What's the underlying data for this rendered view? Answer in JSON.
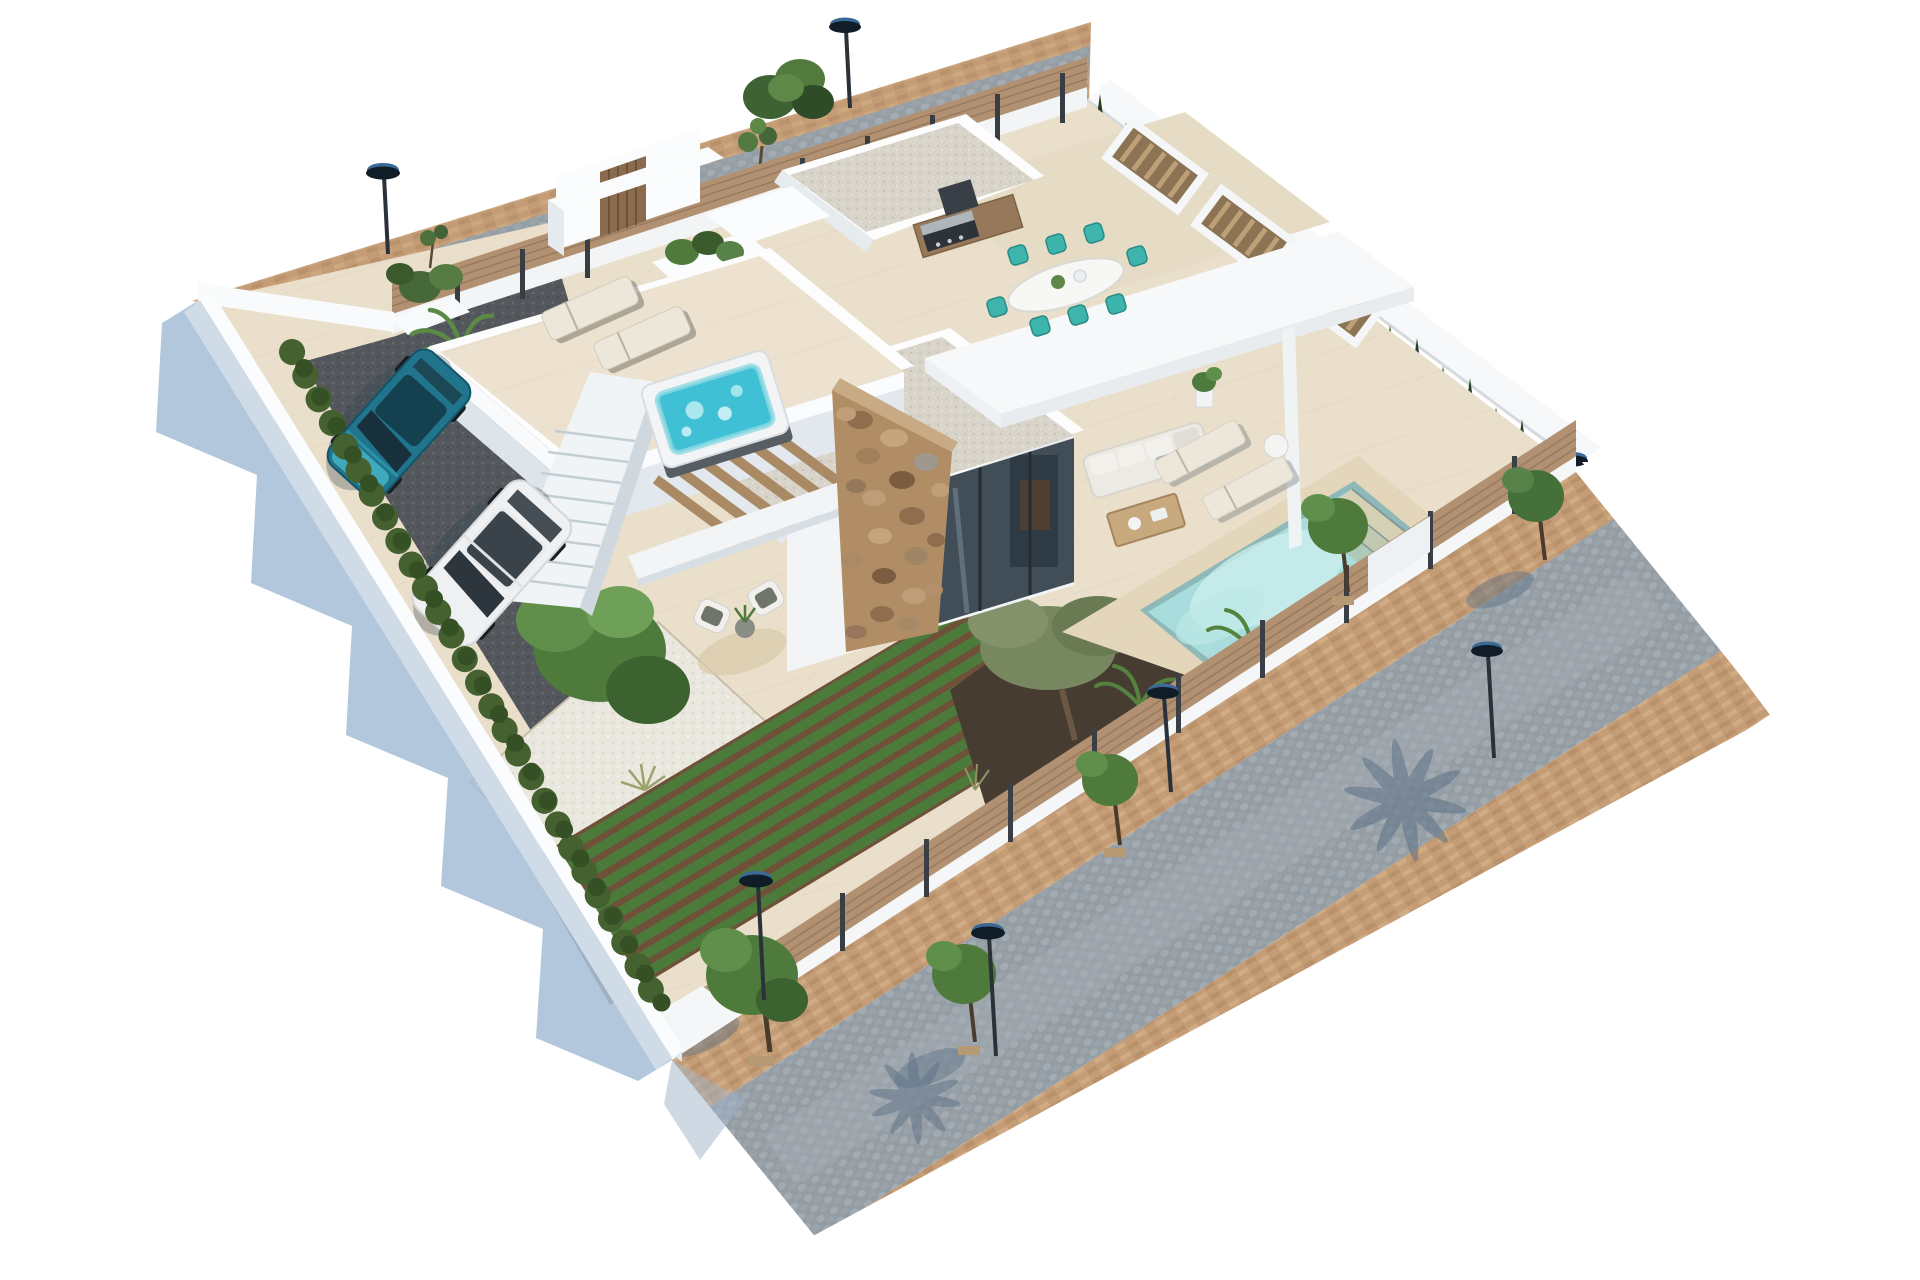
{
  "meta": {
    "type": "architectural-3d-render",
    "subject": "aerial isometric view of a modern white villa plot",
    "canvas": {
      "width": 1920,
      "height": 1280
    }
  },
  "colors": {
    "background": "#ffffff",
    "wall_white": "#f8fafb",
    "wall_lit": "#fdfdfd",
    "wall_shade": "#dfe6ec",
    "shadow_blue": "#a7bed7",
    "paver_tan": "#c49d77",
    "cobble_grey": "#98a0a7",
    "tile_cream": "#e9dfcb",
    "deck_tan": "#e3d6ba",
    "gravel_roof": "#d8d4ca",
    "gravel_drive": "#54585d",
    "white_gravel": "#eae7df",
    "hedge_green": "#44612f",
    "cypress_green": "#2b4022",
    "tree_green": "#4e7b3c",
    "veg_green": "#4c7a3b",
    "soil_brown": "#6e5138",
    "mulch_dark": "#473c32",
    "pool_water": "#a9dddd",
    "pool_light": "#cdeeed",
    "jacuzzi_water": "#3fc0d4",
    "stone_tan": "#b18d66",
    "wood_fence": "#b29173",
    "wood_slat": "#a98a64",
    "chair_teal": "#3db4ac",
    "lounger_cream": "#ece7da",
    "car_teal": "#20758c",
    "car_white": "#eef0f1",
    "glass_dark": "#414d57",
    "lamp_dark": "#16222e"
  },
  "scene": {
    "streets": {
      "north_street": {
        "surfaces": [
          "tan pavers",
          "grey cobblestone"
        ],
        "lamps": 2,
        "features": [
          "green bush",
          "young tree"
        ]
      },
      "southeast_street": {
        "surfaces": [
          "tan paver sidewalk",
          "grey cobblestone road",
          "tan paver sidewalk"
        ],
        "lamps": 4,
        "trees": 5,
        "shadows": [
          "palm frond shadow",
          "tree shadows"
        ]
      }
    },
    "plot": {
      "boundaries": [
        "wood slat fence with entrance portal (NW)",
        "white wall with cypress hedge (NE)",
        "wood fence on white base (SE)",
        "white wall with hedge row (SW)"
      ],
      "ground": [
        "cream tile terrace",
        "dark gravel driveway",
        "white gravel garden",
        "vegetable garden rows",
        "dark mulch beds"
      ]
    },
    "house": {
      "roofs": [
        "white gravel flat roof (rear block)",
        "white gravel flat roof (main block)",
        "white cantilever roof slab"
      ],
      "features": [
        "rustic stone feature wall",
        "glass sliding doors",
        "timber pergola slats",
        "external staircase",
        "roof terrace"
      ]
    },
    "outdoor": {
      "roof_terrace": [
        "two cream sun loungers",
        "hot tub with turquoise water",
        "agave planter"
      ],
      "dining_terrace": [
        "white oval table",
        "8 teal chairs",
        "bbq counter",
        "timber louvre planters"
      ],
      "pool_area": [
        "turquoise pool with roman steps",
        "two sun loungers",
        "round side table",
        "banana plants"
      ],
      "lounge": [
        "white outdoor sofa",
        "wood coffee table",
        "two wicker armchairs",
        "potted plant",
        "round rug"
      ],
      "garden": [
        "leafy tree",
        "olive tree",
        "ornamental grasses",
        "corner planter bush",
        "banana planter"
      ]
    },
    "vehicles": [
      {
        "type": "hatchback",
        "color_name": "teal"
      },
      {
        "type": "suv",
        "color_name": "white"
      }
    ]
  }
}
